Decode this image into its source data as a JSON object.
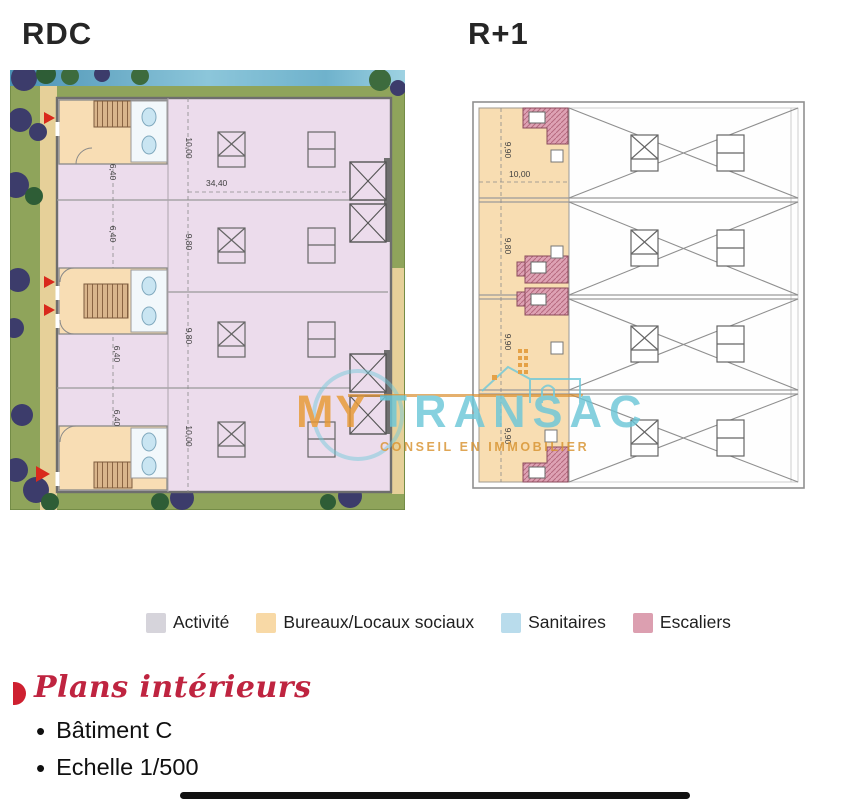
{
  "floor_titles": {
    "rdc": "RDC",
    "r1": "R+1"
  },
  "rdc_plan": {
    "dims": {
      "h_width": "34,40",
      "v_bay1": "10,00",
      "v_bay2": "9,80",
      "v_bay3": "9,80",
      "v_bay4": "10,00",
      "left_1": "6,40",
      "left_2": "6,40",
      "left_3": "6,40",
      "left_4": "6,40"
    }
  },
  "r1_plan": {
    "dims": {
      "h_width": "10,00",
      "v_band1": "9,90",
      "v_band2": "9,80",
      "v_band3": "9,90",
      "v_band4": "9,90"
    }
  },
  "watermark": {
    "brand_left": "MY",
    "brand_right": "TRANSAC",
    "tagline": "CONSEIL EN IMMOBILIER",
    "color_orange": "#e1952f",
    "color_teal": "#6cc7d8"
  },
  "legend": {
    "items": [
      {
        "label": "Activité",
        "color": "#d6d4db"
      },
      {
        "label": "Bureaux/Locaux sociaux",
        "color": "#f8d9a6"
      },
      {
        "label": "Sanitaires",
        "color": "#b9dcec"
      },
      {
        "label": "Escaliers",
        "color": "#dc9fb0"
      }
    ]
  },
  "footer": {
    "heading": "Plans intérieurs",
    "heading_color": "#bf2440",
    "bullets": [
      "Bâtiment C",
      "Echelle 1/500"
    ]
  }
}
